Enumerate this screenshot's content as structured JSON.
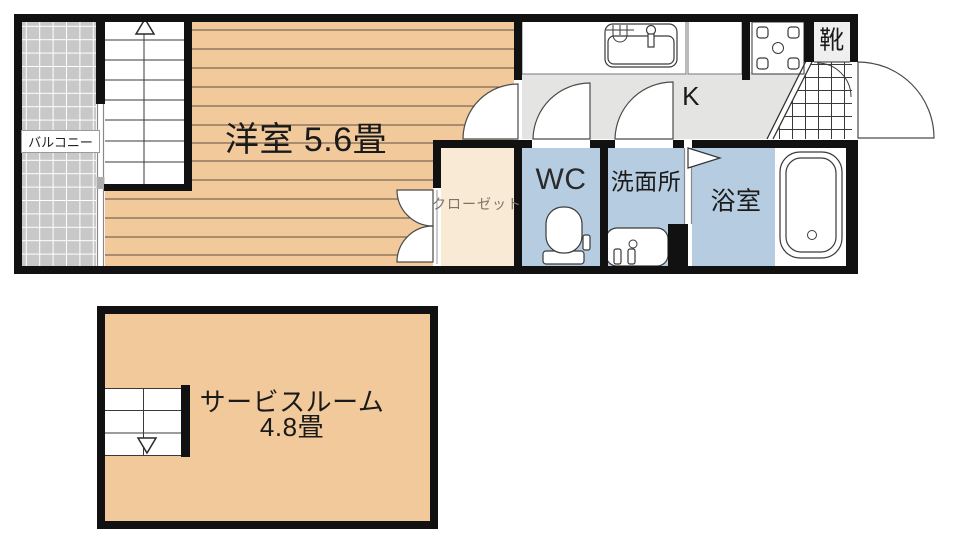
{
  "plan": {
    "floor1": {
      "balcony": {
        "label": "バルコニー"
      },
      "western_room": {
        "label": "洋室 5.6畳"
      },
      "closet": {
        "label": "クローゼット"
      },
      "wc": {
        "label": "WC"
      },
      "washroom": {
        "label": "洗面所"
      },
      "bathroom": {
        "label": "浴室"
      },
      "kitchen": {
        "label": "K"
      },
      "shoe_box": {
        "label": "靴"
      }
    },
    "floor2": {
      "service_room": {
        "label": "サービスルーム",
        "size": "4.8畳"
      }
    },
    "icons": {
      "stairs_up_arrow": "triangle-up-outline",
      "stairs_down_arrow": "triangle-down-outline",
      "kitchen_sink": "counter-sink-with-faucet",
      "stove": "cooktop-square-with-burner-circle",
      "toilet": "toilet-bowl-with-tank",
      "washbasin": "vanity-sink-with-taps",
      "bathtub": "rounded-tub-with-drain",
      "door_swings": "quarter-circle-arcs",
      "folding_door": "right-pointing-flag",
      "entrance_tile": "cross-hatch-grid",
      "balcony_deck": "square-grid"
    },
    "colors": {
      "wood_floor": "#f1c99b",
      "wood_line": "#5f4f41",
      "wet_area": "#b6cce0",
      "closet": "#f8ead4",
      "kitchen_floor": "#e4e4e3",
      "balcony": "#c8c8c8",
      "shoe_box_bg": "#efefef",
      "wall": "#111111"
    }
  }
}
